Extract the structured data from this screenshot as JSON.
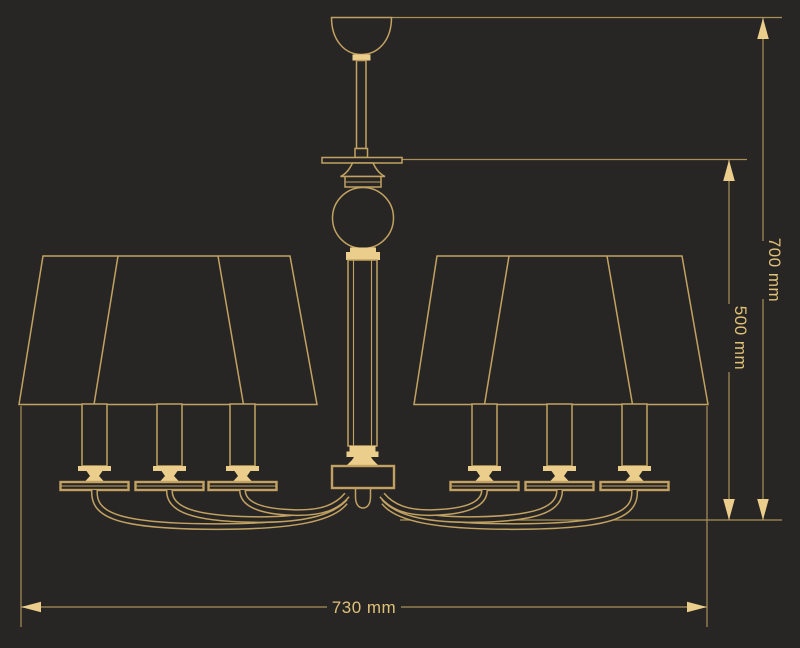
{
  "figure": {
    "type": "technical-dimension-drawing",
    "colors": {
      "background": "#282624",
      "line": "#C2A262",
      "dim_line": "#A98F57",
      "fill": "#ECCE8C",
      "text": "#DFC178"
    }
  },
  "dimensions": {
    "overall_width": "730 mm",
    "overall_height": "700 mm",
    "body_height": "500 mm"
  }
}
